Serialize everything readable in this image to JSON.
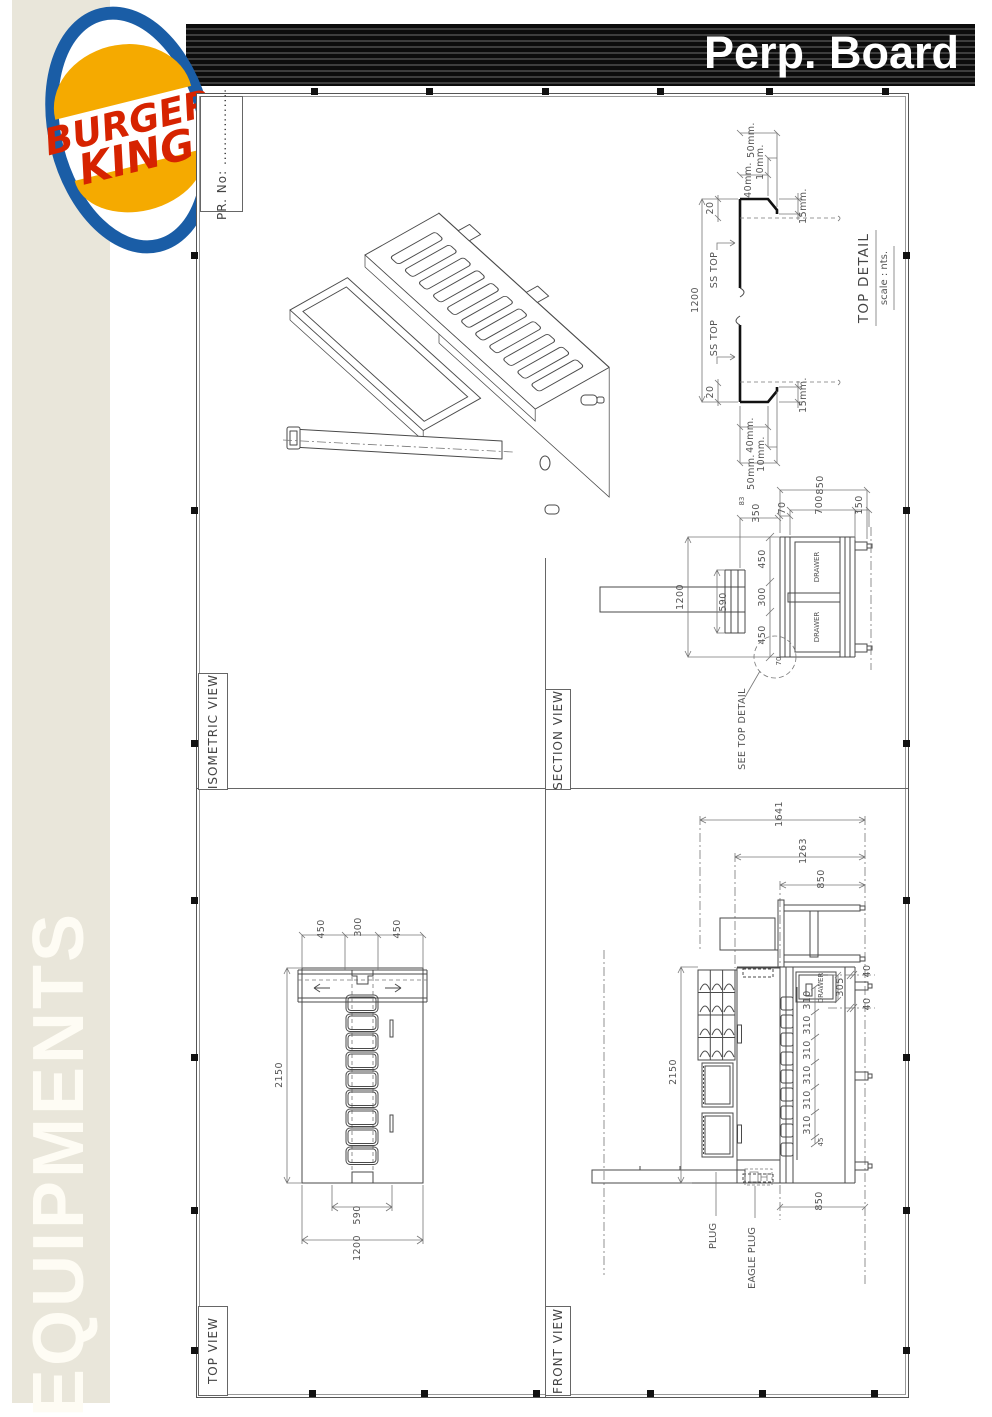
{
  "header": {
    "title": "Perp. Board"
  },
  "sidebar": {
    "label": "EQUIPMENTS"
  },
  "logo": {
    "top": "BURGER",
    "bottom": "KING",
    "registered": "®"
  },
  "colors": {
    "banner_black": "#0c0c0c",
    "sidebar_beige": "#e9e6da",
    "logo_red": "#d62300",
    "logo_yellow": "#f5aa00",
    "logo_blue": "#1a5da6",
    "drawing_line": "#4a4a4a"
  },
  "titleblock": {
    "pr_no": "PR. No: ................"
  },
  "views": {
    "isometric": {
      "label": "ISOMETRIC VIEW"
    },
    "top_detail": {
      "title": "TOP DETAIL",
      "scale": "scale : nts.",
      "callout": "SS TOP",
      "dims": {
        "d50": "50mm.",
        "d10": "10mm.",
        "d40": "40mm.",
        "d15": "15mm.",
        "d20": "20",
        "overall": "1200"
      }
    },
    "section": {
      "label": "SECTION VIEW",
      "drawer": "DRAWER",
      "note": "SEE TOP DETAIL",
      "dims": {
        "d850": "850",
        "d70": "70",
        "d700": "700",
        "d150": "150",
        "d350": "350",
        "d83": "83",
        "d450": "450",
        "d300": "300",
        "overall": "1200",
        "d590": "590",
        "detail70": "70"
      }
    },
    "top_view": {
      "label": "TOP VIEW",
      "dims": {
        "d450": "450",
        "d300": "300",
        "d2150": "2150",
        "d590": "590",
        "d1200": "1200"
      }
    },
    "front_view": {
      "label": "FRONT VIEW",
      "drawer": "DRAWER.",
      "plug": "PLUG",
      "eagle_plug": "EAGLE PLUG",
      "dims": {
        "d1641": "1641",
        "d1263": "1263",
        "d850_top": "850",
        "d40": "40",
        "d305": "305",
        "d310": "310",
        "d45": "45",
        "d2150": "2150",
        "d850_bottom": "850"
      }
    }
  }
}
